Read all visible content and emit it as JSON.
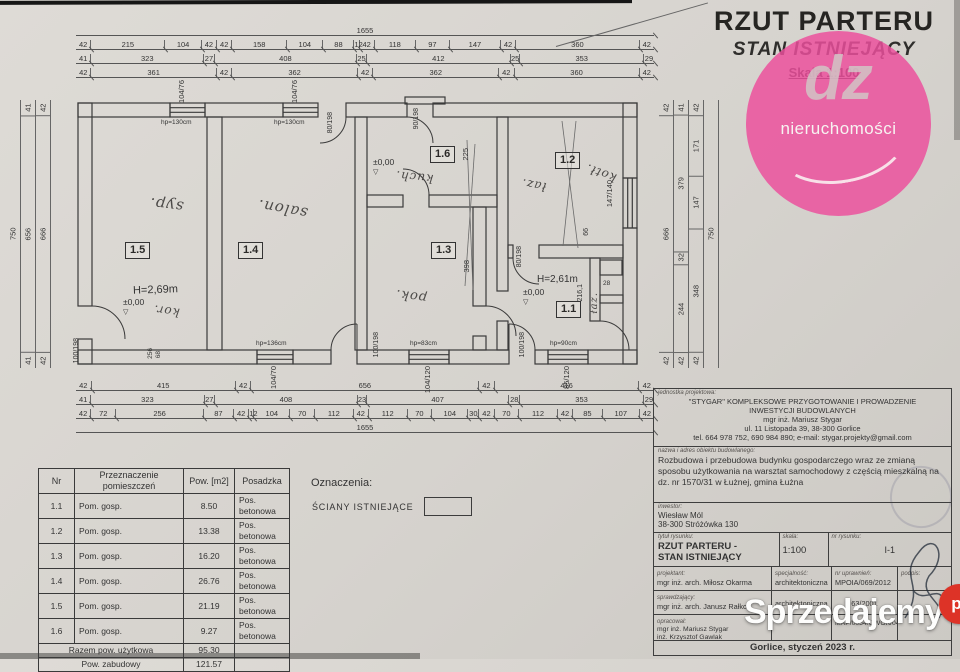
{
  "header": {
    "title": "RZUT PARTERU",
    "subtitle": "STAN ISTNIEJĄCY",
    "scale": "Skala 1:100"
  },
  "logo": {
    "text": "dz",
    "caption": "nieruchomości"
  },
  "watermark": {
    "main": "Sprzedajemy",
    "tld": "pl"
  },
  "plan": {
    "rooms": {
      "r15": "1.5",
      "r14": "1.4",
      "r16": "1.6",
      "r13": "1.3",
      "r12": "1.2",
      "r11": "1.1"
    },
    "hand": {
      "syp": "syp.",
      "salon": "salon.",
      "kuch": "kuch.",
      "pok": "pok.",
      "laz": "łaz.",
      "kotl": "kotł.",
      "kor": "kor.",
      "laz2": "łaz."
    },
    "levels": {
      "zero": "±0,00",
      "tri": "▽"
    },
    "heights": {
      "h15": "H=2,69m",
      "h11": "H=2,61m"
    },
    "windows": {
      "w1": {
        "size": "104/76",
        "sill": "hp=130cm"
      },
      "w2": {
        "size": "104/76",
        "sill": "hp=130cm"
      },
      "w3": {
        "size": "104/70",
        "sill": "hp=136cm"
      },
      "w4": {
        "size": "104/120",
        "sill": "hp=83cm"
      },
      "w5": {
        "size": "85/120",
        "sill": "hp=90cm"
      },
      "w6": {
        "size": "147/140"
      }
    },
    "doors": {
      "d1": "90/198",
      "d2": "80/198",
      "d3": "100/198",
      "d4": "100/198",
      "d5": "100/198",
      "d6": "80/198"
    },
    "inner_dims": {
      "a": "225",
      "b": "398",
      "c": "66",
      "d": "216,1",
      "e": "28",
      "f": "256",
      "g": "68"
    }
  },
  "dimensions": {
    "top_total": [
      "1655"
    ],
    "top_rows": [
      [
        "42",
        "215",
        "104",
        "42",
        "42",
        "158",
        "104",
        "88",
        "12",
        "42",
        "118",
        "97",
        "147",
        "42",
        "360",
        "42"
      ],
      [
        "41",
        "323",
        "27",
        "408",
        "25",
        "412",
        "25",
        "353",
        "29"
      ],
      [
        "42",
        "361",
        "42",
        "362",
        "42",
        "362",
        "42",
        "360",
        "42"
      ]
    ],
    "bottom_rows": [
      [
        "42",
        "415",
        "42",
        "656",
        "42",
        "416",
        "42"
      ],
      [
        "41",
        "323",
        "27",
        "408",
        "23",
        "407",
        "28",
        "353",
        "29"
      ],
      [
        "42",
        "72",
        "256",
        "87",
        "42",
        "12",
        "104",
        "70",
        "112",
        "42",
        "112",
        "70",
        "104",
        "30",
        "42",
        "70",
        "112",
        "42",
        "85",
        "107",
        "42"
      ]
    ],
    "bottom_total": [
      "1655"
    ],
    "left_cols": [
      [
        "750"
      ],
      [
        "41",
        "656",
        "41"
      ],
      [
        "42",
        "666",
        "42"
      ]
    ],
    "right_cols": [
      [
        "42",
        "666",
        "42"
      ],
      [
        "41",
        "379",
        "32",
        "244",
        "42"
      ],
      [
        "42",
        "171",
        "147",
        "348",
        "42"
      ],
      [
        "750"
      ]
    ]
  },
  "legend": {
    "title": "Oznaczenia:",
    "wall_label": "ŚCIANY ISTNIEJĄCE"
  },
  "room_table": {
    "headers": [
      "Nr",
      "Przeznaczenie pomieszczeń",
      "Pow. [m2]",
      "Posadzka"
    ],
    "rows": [
      [
        "1.1",
        "Pom. gosp.",
        "8.50",
        "Pos. betonowa"
      ],
      [
        "1.2",
        "Pom. gosp.",
        "13.38",
        "Pos. betonowa"
      ],
      [
        "1.3",
        "Pom. gosp.",
        "16.20",
        "Pos. betonowa"
      ],
      [
        "1.4",
        "Pom. gosp.",
        "26.76",
        "Pos. betonowa"
      ],
      [
        "1.5",
        "Pom. gosp.",
        "21.19",
        "Pos. betonowa"
      ],
      [
        "1.6",
        "Pom. gosp.",
        "9.27",
        "Pos. betonowa"
      ]
    ],
    "total_label": "Razem pow. użytkowa",
    "total_value": "95.30",
    "built_label": "Pow. zabudowy",
    "built_value": "121.57"
  },
  "title_block": {
    "unit_label": "jednostka projektowa:",
    "unit_line1": "\"STYGAR\" KOMPLEKSOWE PRZYGOTOWANIE I PROWADZENIE",
    "unit_line2": "INWESTYCJI BUDOWLANYCH",
    "unit_line3": "mgr inż. Mariusz Stygar",
    "unit_line4": "ul. 11 Listopada 39, 38-300 Gorlice",
    "unit_line5": "tel. 664 978 752, 690 984 890;  e-mail: stygar.projekty@gmail.com",
    "object_label": "nazwa i adres obiektu budowlanego:",
    "object_text": "Rozbudowa i przebudowa budynku gospodarczego wraz ze zmianą sposobu użytkowania na warsztat samochodowy z częścią mieszkalną na dz. nr 1570/31 w Łużnej, gmina Łużna",
    "investor_label": "inwestor:",
    "investor_name": "Wiesław Mól",
    "investor_addr": "38-300 Stróżówka 130",
    "title_label": "tytuł rysunku:",
    "title_line1": "RZUT PARTERU -",
    "title_line2": "STAN ISTNIEJĄCY",
    "scale_label": "skala:",
    "scale_value": "1:100",
    "dwg_no_label": "nr rysunku:",
    "dwg_no_value": "I-1",
    "spec_label": "specjalność:",
    "cert_label": "nr uprawnień:",
    "sign_label": "podpis:",
    "roles": [
      {
        "label": "projektant:",
        "name": "mgr inż. arch. Miłosz Okarma",
        "spec": "architektoniczna",
        "cert": "MPOIA/069/2012"
      },
      {
        "label": "sprawdzający:",
        "name": "mgr inż. arch. Janusz Rałko",
        "spec": "architektoniczna",
        "cert": "63/2001"
      },
      {
        "label": "opracował:",
        "name": "mgr inż. Mariusz Stygar",
        "name2": "inż. Krzysztof Gawlak",
        "name3": "inż. Marcin Dutka",
        "cert": "MAP/0054/OWOK/04"
      }
    ],
    "footer": "Gorlice, styczeń 2023 r."
  }
}
